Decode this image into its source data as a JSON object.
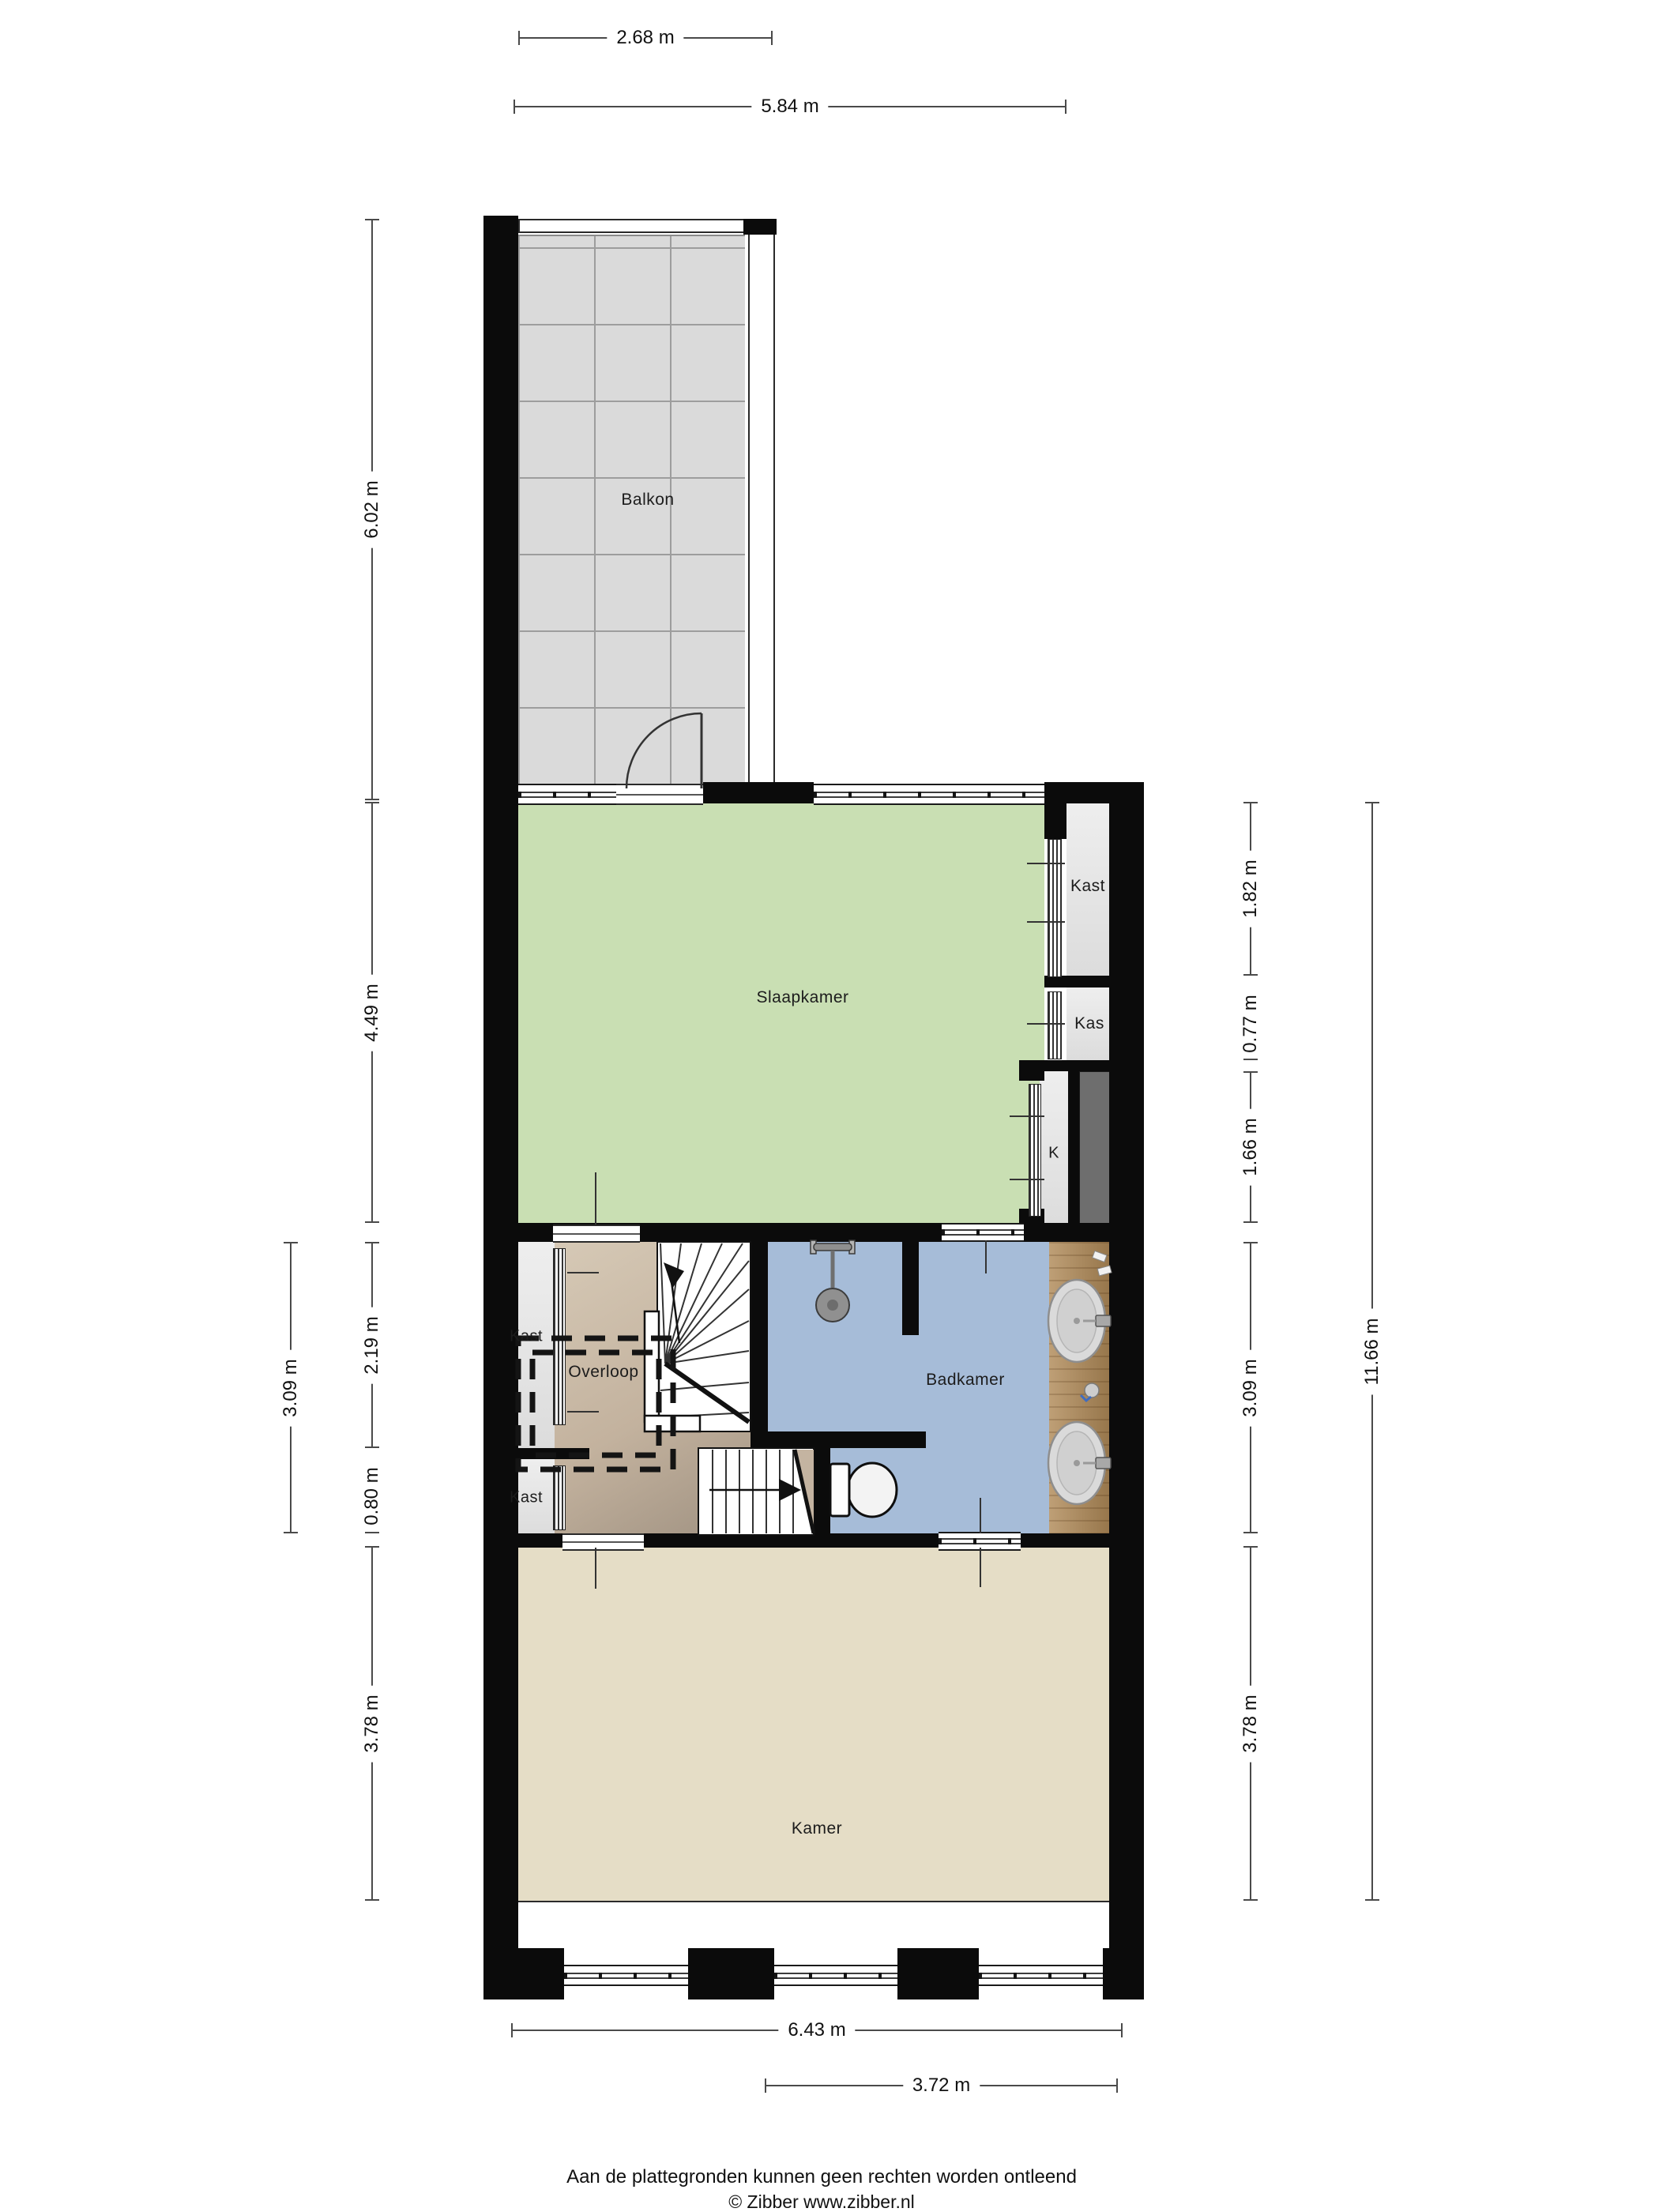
{
  "rooms": {
    "balkon": {
      "label": "Balkon"
    },
    "slaapkamer": {
      "label": "Slaapkamer"
    },
    "kast_slaapkamer": {
      "label": "Kast"
    },
    "kas": {
      "label": "Kas"
    },
    "k": {
      "label": "K"
    },
    "overloop": {
      "label": "Overloop"
    },
    "kast_overloop": {
      "label": "Kast"
    },
    "kast_klein": {
      "label": "Kast"
    },
    "badkamer": {
      "label": "Badkamer"
    },
    "kamer": {
      "label": "Kamer"
    }
  },
  "dimensions": {
    "top": [
      {
        "label": "2.68 m"
      },
      {
        "label": "5.84 m"
      }
    ],
    "left_outer": [
      {
        "label": "3.09 m"
      }
    ],
    "left_inner": [
      {
        "label": "6.02 m"
      },
      {
        "label": "4.49 m"
      },
      {
        "label": "2.19 m"
      },
      {
        "label": "0.80 m"
      },
      {
        "label": "3.78 m"
      }
    ],
    "right_inner": [
      {
        "label": "1.82 m"
      },
      {
        "label": "0.77 m"
      },
      {
        "label": "1.66 m"
      },
      {
        "label": "3.09 m"
      },
      {
        "label": "3.78 m"
      }
    ],
    "right_outer": [
      {
        "label": "11.66 m"
      }
    ],
    "bottom": [
      {
        "label": "6.43 m"
      },
      {
        "label": "3.72 m"
      }
    ]
  },
  "footer": {
    "disclaimer": "Aan de plattegronden kunnen geen rechten worden ontleend",
    "copyright": "© Zibber www.zibber.nl"
  },
  "colors": {
    "wall": "#0b0b0b",
    "slaapkamer": "#c9dfb3",
    "badkamer": "#a6bcd8",
    "kamer": "#e5ddc6",
    "overloop": "#c3b29e",
    "balkon_tegels": "#dadada",
    "kast": "#e6e6e6",
    "schacht": "#6e6e6e",
    "wastafel_blad": "#b08a58"
  }
}
